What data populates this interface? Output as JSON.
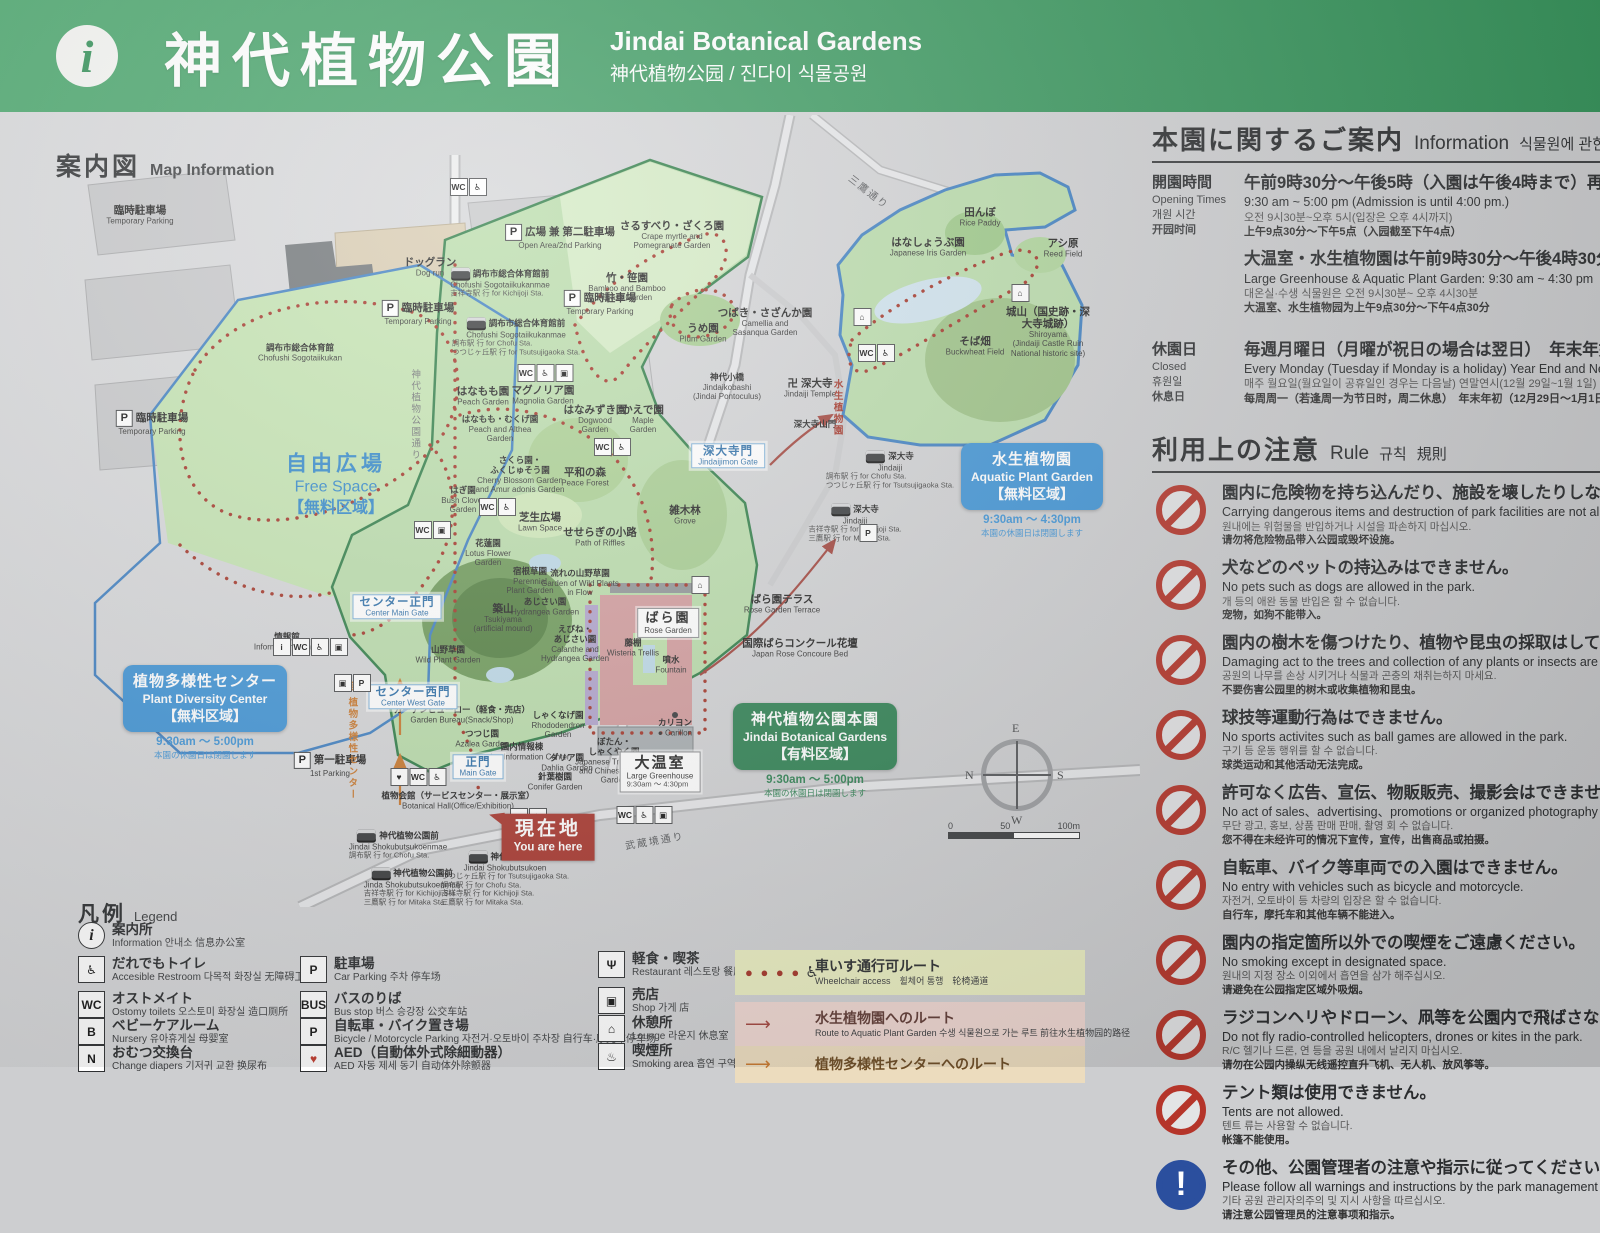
{
  "header": {
    "title_ja": "神代植物公園",
    "title_en": "Jindai Botanical Gardens",
    "subtitle": "神代植物公园 / 진다이 식물공원",
    "info_glyph": "i"
  },
  "map": {
    "heading_ja": "案内図",
    "heading_en": "Map Information",
    "free_space": {
      "ja": "自由広場",
      "en": "Free Space",
      "zone": "【無料区域】"
    },
    "you_are_here": {
      "ja": "現在地",
      "en": "You are here"
    },
    "badges": {
      "pdc": {
        "ja": "植物多様性センター",
        "en": "Plant Diversity Center",
        "zone": "【無料区域】",
        "hours": "9:30am ～ 5:00pm",
        "note": "本園の休園日は閉園します"
      },
      "aquatic": {
        "ja": "水生植物園",
        "en": "Aquatic Plant Garden",
        "zone": "【無料区域】",
        "hours": "9:30am ～ 4:30pm",
        "note": "本園の休園日は閉園します"
      },
      "main": {
        "ja": "神代植物公園本園",
        "en": "Jindai Botanical Gardens",
        "zone": "【有料区域】",
        "hours": "9:30am ～ 5:00pm",
        "note": "本園の休園日は閉園します"
      }
    },
    "gates": [
      {
        "x": 397,
        "y": 492,
        "ja": "センター正門",
        "en": "Center Main Gate"
      },
      {
        "x": 413,
        "y": 582,
        "ja": "センター西門",
        "en": "Center West Gate"
      },
      {
        "x": 478,
        "y": 652,
        "ja": "正門",
        "en": "Main Gate"
      },
      {
        "x": 728,
        "y": 341,
        "ja": "深大寺門",
        "en": "Jindaijimon Gate"
      }
    ],
    "labels": [
      {
        "x": 140,
        "y": 100,
        "ja": "臨時駐車場",
        "en": "Temporary Parking"
      },
      {
        "x": 560,
        "y": 122,
        "ja": "広場 兼 第二駐車場",
        "en": "Open Area/2nd Parking",
        "cls": "pk"
      },
      {
        "x": 430,
        "y": 152,
        "ja": "ドッグラン",
        "en": "Dog run"
      },
      {
        "x": 418,
        "y": 198,
        "ja": "臨時駐車場",
        "en": "Temporary Parking",
        "cls": "pk"
      },
      {
        "x": 600,
        "y": 188,
        "ja": "臨時駐車場",
        "en": "Temporary Parking",
        "cls": "pk"
      },
      {
        "x": 152,
        "y": 308,
        "ja": "臨時駐車場",
        "en": "Temporary Parking",
        "cls": "pk"
      },
      {
        "x": 300,
        "y": 238,
        "ja": "調布市総合体育館",
        "en": "Chofushi Sogotaiikukan",
        "cls": "small"
      },
      {
        "x": 500,
        "y": 168,
        "ja": "調布市総合体育館前",
        "en": "Chofushi Sogotaiikukanmae",
        "sub": "吉祥寺駅 行  for Kichijoji Sta.",
        "cls": "bus small"
      },
      {
        "x": 516,
        "y": 222,
        "ja": "調布市総合体育館前",
        "en": "Chofushi Sogotaiikukanmae",
        "sub": "調布駅 行  for Chofu Sta.\nつつじヶ丘駅 行  for Tsutsujigaoka Sta.",
        "cls": "bus small"
      },
      {
        "x": 672,
        "y": 120,
        "ja": "さるすべり・ざくろ園",
        "en": "Crape myrtle and\nPomegranate Garden"
      },
      {
        "x": 627,
        "y": 172,
        "ja": "竹・笹園",
        "en": "Bamboo and Bamboo\nGrass Garden"
      },
      {
        "x": 703,
        "y": 218,
        "ja": "うめ園",
        "en": "Plum Garden"
      },
      {
        "x": 765,
        "y": 207,
        "ja": "つばき・さざんか園",
        "en": "Camellia and\nSasanqua Garden"
      },
      {
        "x": 727,
        "y": 272,
        "ja": "神代小橋",
        "en": "Jindaikobashi\n(Jindai Pontoculus)",
        "cls": "small"
      },
      {
        "x": 980,
        "y": 102,
        "ja": "田んぼ",
        "en": "Rice Paddy"
      },
      {
        "x": 928,
        "y": 132,
        "ja": "はなしょうぶ園",
        "en": "Japanese Iris Garden"
      },
      {
        "x": 1063,
        "y": 133,
        "ja": "アシ原",
        "en": "Reed Field"
      },
      {
        "x": 1048,
        "y": 217,
        "ja": "城山（国史跡・深大寺城跡）",
        "en": "Shiroyama\n(Jindaiji Castle Ruin National historic site)"
      },
      {
        "x": 975,
        "y": 231,
        "ja": "そば畑",
        "en": "Buckwheat Field"
      },
      {
        "x": 810,
        "y": 273,
        "ja": "卍 深大寺",
        "en": "Jindaiji Temple"
      },
      {
        "x": 815,
        "y": 310,
        "ja": "深大寺山門",
        "cls": "small"
      },
      {
        "x": 483,
        "y": 281,
        "ja": "はなもも園",
        "en": "Peach Garden"
      },
      {
        "x": 543,
        "y": 280,
        "ja": "マグノリア園",
        "en": "Magnolia Garden"
      },
      {
        "x": 595,
        "y": 304,
        "ja": "はなみずき園",
        "en": "Dogwood\nGarden"
      },
      {
        "x": 643,
        "y": 304,
        "ja": "かえで園",
        "en": "Maple\nGarden"
      },
      {
        "x": 500,
        "y": 314,
        "ja": "はなもも・むくげ園",
        "en": "Peach and Althea\nGarden",
        "cls": "small"
      },
      {
        "x": 520,
        "y": 360,
        "ja": "さくら園・\nふくじゅそう園",
        "en": "Cherry Blossom Garden\nand Amur adonis Garden",
        "cls": "small"
      },
      {
        "x": 585,
        "y": 362,
        "ja": "平和の森",
        "en": "Peace Forest"
      },
      {
        "x": 463,
        "y": 385,
        "ja": "はぎ園",
        "en": "Bush Clover\nGarden",
        "cls": "small"
      },
      {
        "x": 540,
        "y": 407,
        "ja": "芝生広場",
        "en": "Lawn Space"
      },
      {
        "x": 600,
        "y": 422,
        "ja": "せせらぎの小路",
        "en": "Path of Riffles"
      },
      {
        "x": 488,
        "y": 438,
        "ja": "花蓮園",
        "en": "Lotus Flower\nGarden",
        "cls": "small"
      },
      {
        "x": 530,
        "y": 466,
        "ja": "宿根草園",
        "en": "Perennial\nPlant Garden",
        "cls": "small"
      },
      {
        "x": 580,
        "y": 468,
        "ja": "流れの山野草園",
        "en": "Garden of Wild Plants\nin Flow",
        "cls": "small"
      },
      {
        "x": 545,
        "y": 492,
        "ja": "あじさい園",
        "en": "Hydrangea Garden",
        "cls": "small"
      },
      {
        "x": 503,
        "y": 503,
        "ja": "築山",
        "en": "Tsukiyama\n(artificial mound)"
      },
      {
        "x": 575,
        "y": 529,
        "ja": "えびね・\nあじさい園",
        "en": "Calanthe and\nHydrangea Garden",
        "cls": "small"
      },
      {
        "x": 448,
        "y": 540,
        "ja": "山野草園",
        "en": "Wild Plant Garden",
        "cls": "small"
      },
      {
        "x": 685,
        "y": 400,
        "ja": "雑木林",
        "en": "Grove"
      },
      {
        "x": 287,
        "y": 527,
        "ja": "情報館",
        "en": "Information Center",
        "cls": "small"
      },
      {
        "x": 330,
        "y": 650,
        "ja": "第一駐車場",
        "en": "1st Parking",
        "cls": "pk"
      },
      {
        "x": 558,
        "y": 610,
        "ja": "しゃくなげ園",
        "en": "Rhododendron\nGarden",
        "cls": "small"
      },
      {
        "x": 482,
        "y": 624,
        "ja": "つつじ園",
        "en": "Azalea Garden",
        "cls": "small"
      },
      {
        "x": 462,
        "y": 600,
        "ja": "ガーデンビューロー（軽食・売店）",
        "en": "Garden Bureau(Snack/Shop)",
        "cls": "small"
      },
      {
        "x": 522,
        "y": 637,
        "ja": "園内情報棟",
        "en": "Garden Information Center",
        "cls": "small"
      },
      {
        "x": 567,
        "y": 648,
        "ja": "ダリア園",
        "en": "Dahlia Garden",
        "cls": "small"
      },
      {
        "x": 555,
        "y": 667,
        "ja": "針葉樹園",
        "en": "Conifer Garden",
        "cls": "small"
      },
      {
        "x": 614,
        "y": 646,
        "ja": "ぼたん・\nしゃくやく園",
        "en": "Japanese Tree Peony\nand Chinese Peony\nGarden",
        "cls": "small"
      },
      {
        "x": 675,
        "y": 613,
        "ja": "カリヨン",
        "en": "● Carillon",
        "cls": "small"
      },
      {
        "x": 660,
        "y": 657,
        "ja": "大温室",
        "en": "Large Greenhouse",
        "sub": "9:30am ～ 4:30pm",
        "cls": "boxed"
      },
      {
        "x": 668,
        "y": 508,
        "ja": "ばら園",
        "en": "Rose Garden",
        "cls": "boxed rose"
      },
      {
        "x": 782,
        "y": 489,
        "ja": "ばら園テラス",
        "en": "Rose Garden Terrace"
      },
      {
        "x": 800,
        "y": 533,
        "ja": "国際ばらコンクール花壇",
        "en": "Japan Rose Concoure Bed"
      },
      {
        "x": 633,
        "y": 533,
        "ja": "藤棚",
        "en": "Wisteria Trellis",
        "cls": "small"
      },
      {
        "x": 671,
        "y": 550,
        "ja": "噴水",
        "en": "Fountain",
        "cls": "small"
      },
      {
        "x": 458,
        "y": 686,
        "ja": "植物会館（サービスセンター・展示室）",
        "en": "Botanical Hall(Office/Exhibition)",
        "cls": "small"
      },
      {
        "x": 890,
        "y": 355,
        "ja": "深大寺",
        "en": "Jindaiji",
        "sub": "調布駅 行  for Chofu Sta.\nつつじヶ丘駅 行  for Tsutsujigaoka Sta.",
        "cls": "bus small"
      },
      {
        "x": 855,
        "y": 408,
        "ja": "深大寺",
        "en": "Jindaiji",
        "sub": "吉祥寺駅 行  for Kichijoji Sta.\n三鷹駅 行  for Mitaka Sta.",
        "cls": "bus small"
      },
      {
        "x": 398,
        "y": 730,
        "ja": "神代植物公園前",
        "en": "Jindai Shokubutsukoenmae",
        "sub": "調布駅 行  for Chofu Sta.",
        "cls": "bus small"
      },
      {
        "x": 505,
        "y": 764,
        "ja": "神代植物公園",
        "en": "Jindai Shokubutsukoen",
        "sub": "つつじヶ丘駅 行  for Tsutsujigaoka Sta.\n調布駅 行  for Chofu Sta.\n吉祥寺駅 行  for Kichijoji Sta.\n三鷹駅 行  for Mitaka Sta.",
        "cls": "bus small"
      },
      {
        "x": 412,
        "y": 772,
        "ja": "神代植物公園前",
        "en": "Jinda Shokubutsukoenmae",
        "sub": "吉祥寺駅 行  for Kichijoji Sta.\n三鷹駅 行  for Mitaka Sta.",
        "cls": "bus small"
      },
      {
        "x": 868,
        "y": 78,
        "ja": "三鷹通り",
        "cls": "road",
        "rot": 38
      },
      {
        "x": 655,
        "y": 727,
        "ja": "武蔵境通り",
        "cls": "road",
        "rot": -10
      },
      {
        "x": 858,
        "y": 293,
        "ja": "水生植物園",
        "cls": "vtext red-vert"
      },
      {
        "x": 400,
        "y": 626,
        "ja": "至 植物多様性センター",
        "cls": "vtext orange-vert"
      },
      {
        "x": 452,
        "y": 300,
        "ja": "神代植物公園通り",
        "cls": "vtext gray-vert"
      }
    ],
    "icon_clusters": [
      {
        "x": 468,
        "y": 72,
        "glyphs": "WC,♿"
      },
      {
        "x": 545,
        "y": 258,
        "glyphs": "WC,♿,▣"
      },
      {
        "x": 612,
        "y": 332,
        "glyphs": "WC,♿"
      },
      {
        "x": 497,
        "y": 392,
        "glyphs": "WC,♿"
      },
      {
        "x": 432,
        "y": 415,
        "glyphs": "WC,▣"
      },
      {
        "x": 862,
        "y": 202,
        "glyphs": "⌂"
      },
      {
        "x": 876,
        "y": 238,
        "glyphs": "WC,♿"
      },
      {
        "x": 310,
        "y": 532,
        "glyphs": "i,WC,♿,▣"
      },
      {
        "x": 352,
        "y": 568,
        "glyphs": "▣,P"
      },
      {
        "x": 418,
        "y": 662,
        "glyphs": "♥,WC,♿"
      },
      {
        "x": 644,
        "y": 700,
        "glyphs": "WC,♿,▣"
      },
      {
        "x": 528,
        "y": 702,
        "glyphs": "WC,♿"
      },
      {
        "x": 868,
        "y": 418,
        "glyphs": "P"
      },
      {
        "x": 1020,
        "y": 178,
        "glyphs": "⌂"
      },
      {
        "x": 700,
        "y": 470,
        "glyphs": "⌂"
      }
    ],
    "compass": {
      "e": "E",
      "n": "N",
      "s": "S",
      "w": "W"
    },
    "scale": {
      "t0": "0",
      "t50": "50",
      "t100": "100m"
    }
  },
  "info_panel": {
    "heading": {
      "ja": "本園に関するご案内",
      "en": "Information",
      "ko": "식물원에 관한 안내"
    },
    "opening": {
      "label": {
        "ja": "開園時間",
        "en": "Opening Times",
        "ko": "개원 시간",
        "zh": "开园时间"
      },
      "block1": {
        "ja": "午前9時30分～午後5時（入園は午後4時まで）再入園可",
        "en": "9:30 am ~ 5:00 pm (Admission is until 4:00 pm.)",
        "ko": "오전 9시30분~오후 5시(입장은 오후 4시까지)",
        "zh": "上午9点30分～下午5点（入园截至下午4点）"
      },
      "block2": {
        "ja": "大温室・水生植物園は午前9時30分～午後4時30分",
        "en": "Large Greenhouse & Aquatic Plant Garden: 9:30 am ~ 4:30 pm",
        "ko": "대온실·수생 식물원은 오전 9시30분~ 오후 4시30분",
        "zh": "大温室、水生植物园为上午9点30分～下午4点30分"
      }
    },
    "closed": {
      "label": {
        "ja": "休園日",
        "en": "Closed",
        "ko": "휴원일",
        "zh": "休息日"
      },
      "block": {
        "ja": "毎週月曜日（月曜が祝日の場合は翌日）　年末年始",
        "en": "Every Monday (Tuesday if Monday is a holiday) Year End and New Year",
        "ko": "매주 월요일(월요일이 공휴일인 경우는 다음날) 연말연시(12월 29일~1월 1일)",
        "zh": "每周周一（若逢周一为节日时，周二休息）　年末年初（12月29日～1月1日）"
      }
    },
    "rules_heading": {
      "ja": "利用上の注意",
      "en": "Rule",
      "ko": "규칙",
      "zh": "規則"
    },
    "rules": [
      {
        "ja": "園内に危険物を持ち込んだり、施設を壊したりしないでください。",
        "en": "Carrying dangerous items and destruction of park facilities are not allowed.",
        "ko": "원내에는 위험물을 반입하거나 시설을 파손하지 마십시오.",
        "zh": "请勿将危险物品带入公园或毁坏设施。"
      },
      {
        "ja": "犬などのペットの持込みはできません。",
        "en": "No pets such as dogs are allowed in the park.",
        "ko": "개 등의 애완 동물 반입은 할 수 없습니다.",
        "zh": "宠物，如狗不能带入。"
      },
      {
        "ja": "園内の樹木を傷つけたり、植物や昆虫の採取はしてはいけません。",
        "en": "Damaging act to the trees and collection of any plants or insects are not allowed.",
        "ko": "공원의 나무를 손상 시키거나 식물과 곤충의 채취는하지 마세요.",
        "zh": "不要伤害公园里的树木或收集植物和昆虫。"
      },
      {
        "ja": "球技等運動行為はできません。",
        "en": "No sports activites such as ball games are allowed in the park.",
        "ko": "구기 등 운동 행위를 할 수 없습니다.",
        "zh": "球类运动和其他活动无法完成。"
      },
      {
        "ja": "許可なく広告、宣伝、物販販売、撮影会はできません。",
        "en": "No act of sales、advertising、promotions or organized photography sessions.",
        "ko": "무단 광고, 홍보, 상품 판매 판매, 촬영 회 수 없습니다.",
        "zh": "您不得在未经许可的情况下宣传，宣传，出售商品或拍摄。"
      },
      {
        "ja": "自転車、バイク等車両での入園はできません。",
        "en": "No entry with vehicles such as bicycle and motorcycle.",
        "ko": "자전거, 오토바이 등 차량의 입장은 할 수 없습니다.",
        "zh": "自行车，摩托车和其他车辆不能进入。"
      },
      {
        "ja": "園内の指定箇所以外での喫煙をご遠慮ください。",
        "en": "No smoking except in designated space.",
        "ko": "원내의 지정 장소 이외에서 흡연을 삼가 해주십시오.",
        "zh": "请避免在公园指定区域外吸烟。"
      },
      {
        "ja": "ラジコンヘリやドローン、凧等を公園内で飛ばさないでください。",
        "en": "Do not fly radio-controlled helicopters, drones or kites in the park.",
        "ko": "R/C 헬기나 드론, 연 등을 공원 내에서 날리지 마십시오.",
        "zh": "请勿在公园内操纵无线遥控直升飞机、无人机、放风筝等。"
      },
      {
        "ja": "テント類は使用できません。",
        "en": "Tents are not allowed.",
        "ko": "텐트 류는 사용할 수 없습니다.",
        "zh": "帐篷不能使用。"
      },
      {
        "ja": "その他、公園管理者の注意や指示に従ってください。",
        "en": "Please follow all warnings and instructions by the park management staff.",
        "ko": "기타 공원 관리자의주의 및 지시 사항을 따르십시오.",
        "zh": "请注意公园管理员的注意事项和指示。",
        "cls": "blue",
        "bang": "!"
      }
    ]
  },
  "legend": {
    "heading": {
      "ja": "凡例",
      "en": "Legend"
    },
    "items": [
      {
        "x": 78,
        "y": 922,
        "icon": "i",
        "cls": "round",
        "ja": "案内所",
        "rest": "Information  안내소  信息办公室"
      },
      {
        "x": 78,
        "y": 956,
        "icon": "♿",
        "ja": "だれでもトイレ",
        "rest": "Accesible Restroom  다목적 화장실  无障碍卫生间"
      },
      {
        "x": 78,
        "y": 991,
        "icon": "WC",
        "ja": "オストメイト",
        "rest": "Ostomy toilets  오스토미 화장실  造口厕所"
      },
      {
        "x": 78,
        "y": 1018,
        "icon": "B",
        "ja": "ベビーケアルーム",
        "rest": "Nursery  유아휴게실  母婴室"
      },
      {
        "x": 78,
        "y": 1045,
        "icon": "N",
        "ja": "おむつ交換台",
        "rest": "Change diapers  기저귀 교환  换尿布"
      },
      {
        "x": 300,
        "y": 956,
        "icon": "P",
        "ja": "駐車場",
        "rest": "Car Parking  주차  停车场"
      },
      {
        "x": 300,
        "y": 991,
        "icon": "BUS",
        "ja": "バスのりば",
        "rest": "Bus stop  버스 승강장  公交车站"
      },
      {
        "x": 300,
        "y": 1018,
        "icon": "P",
        "ja": "自転車・バイク置き場",
        "rest": "Bicycle / Motorcycle Parking  자전거·오토바이 주차장  自行车·摩托车停车场"
      },
      {
        "x": 300,
        "y": 1045,
        "icon": "♥",
        "cls": "red",
        "ja": "AED（自動体外式除細動器）",
        "rest": "AED  자동 제세 동기  自动体外除颤器"
      },
      {
        "x": 598,
        "y": 951,
        "icon": "Ψ",
        "ja": "軽食・喫茶",
        "rest": "Restaurant  레스토랑  餐厅"
      },
      {
        "x": 598,
        "y": 987,
        "icon": "▣",
        "ja": "売店",
        "rest": "Shop  가게  店"
      },
      {
        "x": 598,
        "y": 1015,
        "icon": "⌂",
        "ja": "休憩所",
        "rest": "Lounge  라운지  休息室"
      },
      {
        "x": 598,
        "y": 1043,
        "icon": "♨",
        "ja": "喫煙所",
        "rest": "Smoking area  흡연 구역  吸烟区"
      }
    ],
    "routes": [
      {
        "ja": "車いす通行可ルート",
        "rest": "Wheelchair access　휠체어 통행　轮椅通道",
        "marker": "● ● ● ●"
      },
      {
        "ja": "水生植物園へのルート",
        "rest": "Route to Aquatic Plant Garden  수생 식물원으로 가는 루트  前往水生植物园的路径",
        "marker": "⟶"
      },
      {
        "ja": "植物多様性センターへのルート",
        "rest": "",
        "marker": "⟶"
      }
    ]
  }
}
